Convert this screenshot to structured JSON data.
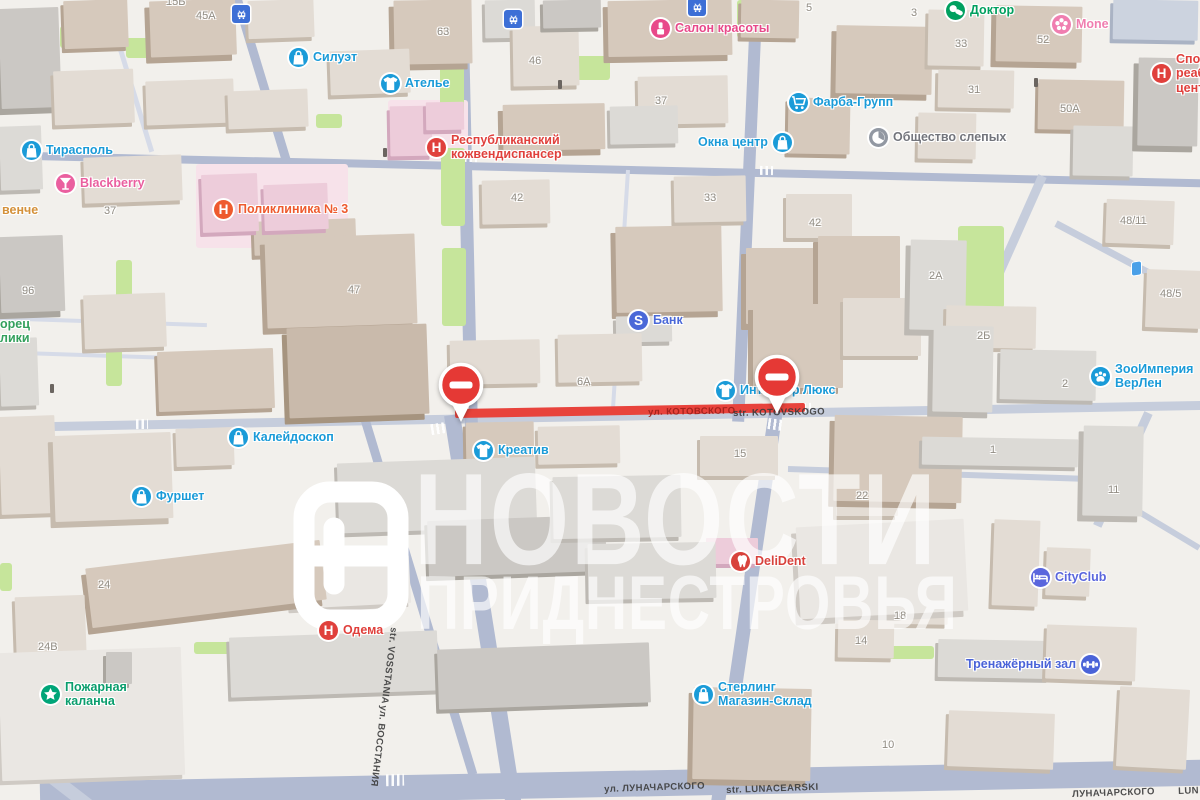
{
  "watermark": {
    "line1": "НОВОСТИ",
    "line2": "ПРИДНЕСТРОВЬЯ"
  },
  "closure": {
    "signs": [
      {
        "x": 438,
        "y": 362
      },
      {
        "x": 754,
        "y": 354
      }
    ],
    "sign_color": "#e53935",
    "closed_road_color": "#e8433c"
  },
  "pois": [
    {
      "id": "tiraspol",
      "icon": "bag",
      "iconColor": "#1a9bd8",
      "textColor": "#1a9bd8",
      "lines": [
        "Тирасполь"
      ],
      "x": 22,
      "y": 141
    },
    {
      "id": "mone",
      "icon": "flower",
      "iconColor": "#f07eb0",
      "textColor": "#f07eb0",
      "lines": [
        "Mone"
      ],
      "x": 1052,
      "y": 15
    },
    {
      "id": "siluet",
      "icon": "bag",
      "iconColor": "#1a9bd8",
      "textColor": "#1a9bd8",
      "lines": [
        "Силуэт"
      ],
      "x": 289,
      "y": 48
    },
    {
      "id": "atelier",
      "icon": "tshirt",
      "iconColor": "#1a9bd8",
      "textColor": "#1a9bd8",
      "lines": [
        "Ателье"
      ],
      "x": 381,
      "y": 74
    },
    {
      "id": "salon-krasoty",
      "icon": "lipstick",
      "iconColor": "#e8498a",
      "textColor": "#e8498a",
      "lines": [
        "Салон красоты"
      ],
      "x": 651,
      "y": 19
    },
    {
      "id": "doktor",
      "icon": "pills",
      "iconColor": "#00a05f",
      "textColor": "#00a05f",
      "lines": [
        "Доктор"
      ],
      "x": 946,
      "y": 1
    },
    {
      "id": "farba-grupp",
      "icon": "cart",
      "iconColor": "#1a9bd8",
      "textColor": "#1a9bd8",
      "lines": [
        "Фарба-Групп"
      ],
      "x": 789,
      "y": 93
    },
    {
      "id": "okna-centr",
      "icon": "bag",
      "iconColor": "#1a9bd8",
      "textColor": "#1a9bd8",
      "lines": [
        "Окна центр"
      ],
      "x": 698,
      "y": 133,
      "iconSide": "right"
    },
    {
      "id": "obschestvo-slepyh",
      "icon": "blind",
      "iconColor": "#9298a2",
      "textColor": "#73757c",
      "lines": [
        "Общество слепых"
      ],
      "x": 869,
      "y": 128
    },
    {
      "id": "sport-reab-centr",
      "icon": "hospital",
      "iconColor": "#e0403c",
      "textColor": "#e0403c",
      "lines": [
        "Спор",
        "реаб",
        "цент"
      ],
      "x": 1152,
      "y": 52
    },
    {
      "id": "blackberry",
      "icon": "cocktail",
      "iconColor": "#ea5f9f",
      "textColor": "#ea5f9f",
      "lines": [
        "Blackberry"
      ],
      "x": 56,
      "y": 174
    },
    {
      "id": "poliklinika-3",
      "icon": "hospital",
      "iconColor": "#ee5a2e",
      "textColor": "#ee5a2e",
      "lines": [
        "Поликлиника № 3"
      ],
      "x": 214,
      "y": 200
    },
    {
      "id": "kozhvendispanser",
      "icon": "hospital",
      "iconColor": "#e0403c",
      "textColor": "#e0403c",
      "lines": [
        "Республиканский",
        "кожвендиспансер"
      ],
      "x": 427,
      "y": 133
    },
    {
      "id": "venche",
      "textColor": "#d4913a",
      "lines": [
        "венче"
      ],
      "x": 2,
      "y": 203
    },
    {
      "id": "dvorec-respubliki",
      "textColor": "#33a05c",
      "lines": [
        "орец",
        "лики"
      ],
      "x": 0,
      "y": 317
    },
    {
      "id": "bank",
      "icon": "bank",
      "iconColor": "#4a68d8",
      "textColor": "#4a68d8",
      "lines": [
        "Банк"
      ],
      "x": 629,
      "y": 311
    },
    {
      "id": "interer-lyuks",
      "icon": "tshirt",
      "iconColor": "#1a9bd8",
      "textColor": "#1a9bd8",
      "lines": [
        "Интерьер Люкс"
      ],
      "x": 716,
      "y": 381
    },
    {
      "id": "zooimperia-verlen",
      "icon": "paw",
      "iconColor": "#1a9bd8",
      "textColor": "#1a9bd8",
      "lines": [
        "ЗооИмперия",
        "ВерЛен"
      ],
      "x": 1091,
      "y": 362
    },
    {
      "id": "kaleidoskop",
      "icon": "bag",
      "iconColor": "#1a9bd8",
      "textColor": "#1a9bd8",
      "lines": [
        "Калейдоскоп"
      ],
      "x": 229,
      "y": 428
    },
    {
      "id": "kreativ",
      "icon": "tshirt",
      "iconColor": "#1a9bd8",
      "textColor": "#1a9bd8",
      "lines": [
        "Креатив"
      ],
      "x": 474,
      "y": 441
    },
    {
      "id": "furshet",
      "icon": "bag",
      "iconColor": "#1a9bd8",
      "textColor": "#1a9bd8",
      "lines": [
        "Фуршет"
      ],
      "x": 132,
      "y": 487
    },
    {
      "id": "delident",
      "icon": "tooth",
      "iconColor": "#d8423c",
      "textColor": "#d8423c",
      "lines": [
        "DeliDent"
      ],
      "x": 731,
      "y": 552
    },
    {
      "id": "cityclub",
      "icon": "bed",
      "iconColor": "#5a66dd",
      "textColor": "#5a66dd",
      "lines": [
        "CityClub"
      ],
      "x": 1031,
      "y": 568
    },
    {
      "id": "odema",
      "icon": "hospital",
      "iconColor": "#e0403c",
      "textColor": "#e0403c",
      "lines": [
        "Одема"
      ],
      "x": 319,
      "y": 621
    },
    {
      "id": "trenazherny-zal",
      "icon": "dumbbell",
      "iconColor": "#4a63d8",
      "textColor": "#4a63d8",
      "lines": [
        "Тренажёрный зал"
      ],
      "x": 966,
      "y": 655,
      "iconSide": "right"
    },
    {
      "id": "pozharnaya-kalancha",
      "icon": "star",
      "iconColor": "#00a578",
      "textColor": "#0a9e6d",
      "lines": [
        "Пожарная",
        "каланча"
      ],
      "x": 41,
      "y": 680
    },
    {
      "id": "sterling",
      "icon": "bag",
      "iconColor": "#1a9bd8",
      "textColor": "#1a9bd8",
      "lines": [
        "Стерлинг",
        "Магазин-Склад"
      ],
      "x": 694,
      "y": 680
    }
  ],
  "house_numbers": [
    {
      "text": "15Б",
      "x": 166,
      "y": -4
    },
    {
      "text": "45A",
      "x": 196,
      "y": 10
    },
    {
      "text": "63",
      "x": 437,
      "y": 26
    },
    {
      "text": "46",
      "x": 529,
      "y": 55
    },
    {
      "text": "37",
      "x": 655,
      "y": 95
    },
    {
      "text": "5",
      "x": 806,
      "y": 2
    },
    {
      "text": "3",
      "x": 911,
      "y": 7
    },
    {
      "text": "33",
      "x": 955,
      "y": 38
    },
    {
      "text": "52",
      "x": 1037,
      "y": 34
    },
    {
      "text": "31",
      "x": 968,
      "y": 84
    },
    {
      "text": "50A",
      "x": 1060,
      "y": 103
    },
    {
      "text": "48/11",
      "x": 1120,
      "y": 215
    },
    {
      "text": "2A",
      "x": 929,
      "y": 270
    },
    {
      "text": "48/5",
      "x": 1160,
      "y": 288
    },
    {
      "text": "2Б",
      "x": 977,
      "y": 330
    },
    {
      "text": "2",
      "x": 1062,
      "y": 378
    },
    {
      "text": "37",
      "x": 104,
      "y": 205
    },
    {
      "text": "42",
      "x": 511,
      "y": 192
    },
    {
      "text": "33",
      "x": 704,
      "y": 192
    },
    {
      "text": "42",
      "x": 809,
      "y": 217
    },
    {
      "text": "96",
      "x": 22,
      "y": 285
    },
    {
      "text": "47",
      "x": 348,
      "y": 284
    },
    {
      "text": "6A",
      "x": 577,
      "y": 376
    },
    {
      "text": "4",
      "x": 787,
      "y": 379
    },
    {
      "text": "15",
      "x": 734,
      "y": 448
    },
    {
      "text": "22",
      "x": 856,
      "y": 490
    },
    {
      "text": "1",
      "x": 990,
      "y": 444
    },
    {
      "text": "11",
      "x": 1108,
      "y": 484
    },
    {
      "text": "18",
      "x": 894,
      "y": 610
    },
    {
      "text": "24",
      "x": 98,
      "y": 579
    },
    {
      "text": "24В",
      "x": 38,
      "y": 641
    },
    {
      "text": "14",
      "x": 855,
      "y": 635
    },
    {
      "text": "10",
      "x": 882,
      "y": 739
    }
  ],
  "street_labels": [
    {
      "text": "ул. КОТОВСКОГО",
      "x": 648,
      "y": 407,
      "rot": -1,
      "color": "#9e1f1a"
    },
    {
      "text": "str. KOTOVSKOGO",
      "x": 733,
      "y": 408,
      "rot": -1,
      "color": "#3c3c3c"
    },
    {
      "text": "str. VOSSTANIA",
      "x": 399,
      "y": 628,
      "rot": 97,
      "color": "#3c3c3c"
    },
    {
      "text": "ул. ВОССТАНИЯ",
      "x": 389,
      "y": 706,
      "rot": 97,
      "color": "#3c3c3c"
    },
    {
      "text": "ул. ЛУНАЧАРСКОГО",
      "x": 604,
      "y": 784,
      "rot": -2,
      "color": "#3c3c3c"
    },
    {
      "text": "str. LUNACEARSKI",
      "x": 726,
      "y": 785,
      "rot": -2,
      "color": "#3c3c3c"
    },
    {
      "text": "ЛУНАЧАРСКОГО",
      "x": 1072,
      "y": 789,
      "rot": -2,
      "color": "#3c3c3c"
    },
    {
      "text": "LUN",
      "x": 1178,
      "y": 786,
      "rot": -2,
      "color": "#3c3c3c"
    }
  ],
  "transit_stops": [
    {
      "x": 232,
      "y": 5
    },
    {
      "x": 504,
      "y": 10
    },
    {
      "x": 688,
      "y": -2
    }
  ],
  "mini_marker": {
    "x": 1132,
    "y": 262
  }
}
